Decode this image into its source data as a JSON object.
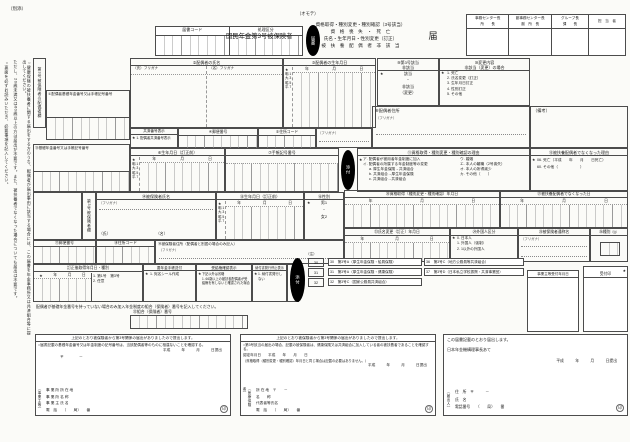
{
  "page": {
    "attachment_note": "（別添）",
    "front_note": "（オモテ）",
    "oval_todokesho": "届書",
    "oval_tenpu": "添付"
  },
  "codes": {
    "col1": "届書コード",
    "col2": "処理区分"
  },
  "title": {
    "prefix": "国民年金第3号被保険者",
    "lines": [
      "資格取得・種別変更・種別確認（3号該当）",
      "資　格　喪　失　・　死　亡",
      "氏名・生年月日・性別変更（訂正）",
      "被　扶　養　配　偶　者　非　該　当"
    ],
    "suffix": "届"
  },
  "approval": {
    "cols": [
      {
        "top": "事務センター長",
        "bottom": "所　　長"
      },
      {
        "top": "副事務センター長",
        "bottom": "副　所　長"
      },
      {
        "top": "グループ長",
        "bottom": "課　　長"
      },
      {
        "top": "担　当　者",
        "bottom": ""
      }
    ]
  },
  "margin": {
    "note1": "○健康保険の被扶養者に関する届出をする方のうち、配偶者が届出事由に該当する場合には、この届書を年金事務所又は共済組合等に提出してください。",
    "note2": "ただし、20歳未満又は60歳以上の方は届出が不要です。また、被扶養者でなくなった場合についても届出は不要です。",
    "note3": "○裏面を必ずお読みいただき、必要事項を記入してください。"
  },
  "misc": {
    "star": "★",
    "furigana": "（フリガナ）",
    "y": "年",
    "m": "月",
    "d": "日",
    "sei": "（氏）",
    "mei": "（名）",
    "seal": "印",
    "era": [
      "明.1",
      "大.3",
      "昭.5",
      "平.7"
    ]
  },
  "a": {
    "label": "第3号被保険者の配偶者欄",
    "f1": "①配偶者基礎年金番号又は手帳記号番号",
    "f2": "②配偶者の氏名",
    "f2_sei": "（氏）フリガナ",
    "f2_mei": "（名）フリガナ",
    "f3": "③配偶者の生年月日",
    "f9a": "⑨第3号該当",
    "f9b": "非該当",
    "f9_items": [
      "該当",
      "・",
      "非該当",
      "（変更）"
    ],
    "f10a": "⑩変更内容",
    "f10b": "非該当（変更）の場合",
    "f10_items": [
      "1. 死亡",
      "2. 氏名変更（訂正）",
      "3. 生年月日訂正",
      "4. 性別訂正",
      "5. その他"
    ],
    "kyosai": "共済番号表示",
    "kyosai_item": "1. 配偶者共済番号表示",
    "f4": "④郵便番号",
    "f5": "⑤住所コード",
    "f8": "⑧配偶者住所",
    "biko": "（備考）",
    "f6": "⑥生年月日（訂正前）",
    "f7": "⑦手帳記号番号",
    "f11": "⑪資格取得・種別変更・種別確認の理由",
    "f11_col1": [
      "ア. 配偶者が被用者年金制度に加入",
      "イ. 配偶者の所属する年金制度等の変更",
      "a. 厚生年金保険→共済組合",
      "b. 共済組合→厚生年金保険",
      "c. 共済組合→共済組合"
    ],
    "f11_col2": [
      "ウ. 婚姻",
      "エ. 本人の離職（2号喪失）",
      "オ. 本人の所得減少",
      "カ. その他（　　）"
    ],
    "f12": "⑫被扶養配偶者でなくなった理由",
    "f12_items": [
      "06. 死亡（平成　　年　　月　　日死亡）",
      "60. その他（　　　　　　）"
    ]
  },
  "b": {
    "label": "第3号被保険者欄",
    "f13": "⑬基礎年金番号又は手帳記号番号",
    "f14": "⑭被保険者氏名",
    "f15": "⑮生年月日（訂正前）",
    "f16": "⑯性別",
    "f16_items": [
      "男1",
      "・",
      "女2"
    ],
    "f20": "⑳資格取得（種別変更・種別確認）年月日",
    "f21": "㉑被扶養配偶者でなくなった日",
    "f23": "㉓氏名変更（訂正）年月日",
    "f24": "㉔外国人区分",
    "f24_items": [
      "0. 日本人",
      "1. 外国人（強制）",
      "2. 1以外の外国人"
    ],
    "f25": "㉕被保険者通称名",
    "f26": "㉖種別",
    "f17": "⑰郵便番号",
    "f18": "⑱住所コード",
    "f19": "⑲被保険者住所（配偶者と別居の場合のみ記入）",
    "correct": "訂正後取得年月日・種別",
    "correct_items": [
      "1. 第1号　第3号",
      "2. 任意"
    ],
    "techo": "要年金手帳送付",
    "techo_item": "1. 宛名シール作成",
    "jukyu": "受給権確認表示",
    "jukyu_items": [
      "下記以外は省略",
      "1. 66歳以上の被扶養配偶者が受給権を有しないと確認された場合"
    ],
    "nofu": "納付書発行停止表示",
    "nofu_item": "1. 納付書発行しない",
    "soshin": "送信",
    "note_mark": "（注）",
    "note_codes": [
      "30",
      "31",
      "32"
    ],
    "legend1": [
      "30　第3号A（厚生年金保険・船員保険）",
      "31　第3号A（厚生年金保険・健康保険）",
      "32　第3号C（国家公務員共済組合）"
    ],
    "legend2": [
      "36　第3号C（地方公務員等共済組合）",
      "37　第3号D（日本私立学校振興・共済事業団）"
    ],
    "uketsuke": "事業主等受付年月日",
    "uketsukein": "受付印",
    "kumiai_note": "配偶者が基礎年金番号を持っていない場合のみ加入年金制度の組合（保険者）番号を記入してください。",
    "f22": "㉒組合（保険者）番号"
  },
  "bottom": {
    "l_header": "上記のとおり被保険者から第3号関係の届出がありましたので提出します。",
    "l_confirm": "○届書記載の基礎年金番号又は年金制度の記号番号は、当該配偶者等のものに相違ないことを確認する。",
    "date": "平成　　　年　　　月　　　日提出",
    "post": "〒　　　　－",
    "l_role": "（事業主等）",
    "l_lines": [
      "事 業 所 所 在 地",
      "事 業 所 名 称",
      "事 業 主 氏 名",
      "電　話　　（　　局）　　番"
    ],
    "m_header": "上記のとおり被保険者から第3号関係の届出がありましたので提出します。",
    "m_confirm": "○第3号該当の届出の場合、記載の被保険者は、健康保険又は共済組合に加入している者の被扶養者であることを確認する。",
    "m_date_label": "認定年月日　　平成　　年　　月　　日",
    "m_note": "（資格取得（種別変更・種別確認）年月日と同じ場合は記載の必要はありません。）",
    "m_role": "（医療保険者）",
    "m_lines": [
      "所 在 地　〒　　－",
      "名　　称",
      "代表者等氏名",
      "電　話　　（　　局）　　番"
    ],
    "r_header": "この届書記載のとおり届出します。",
    "r_to": "日本年金機構理事長あて",
    "r_role": "（届出人）",
    "r_lines": [
      "住　所　〒　　　－",
      "氏　名",
      "電話番号　　（　　局）　　番"
    ]
  }
}
